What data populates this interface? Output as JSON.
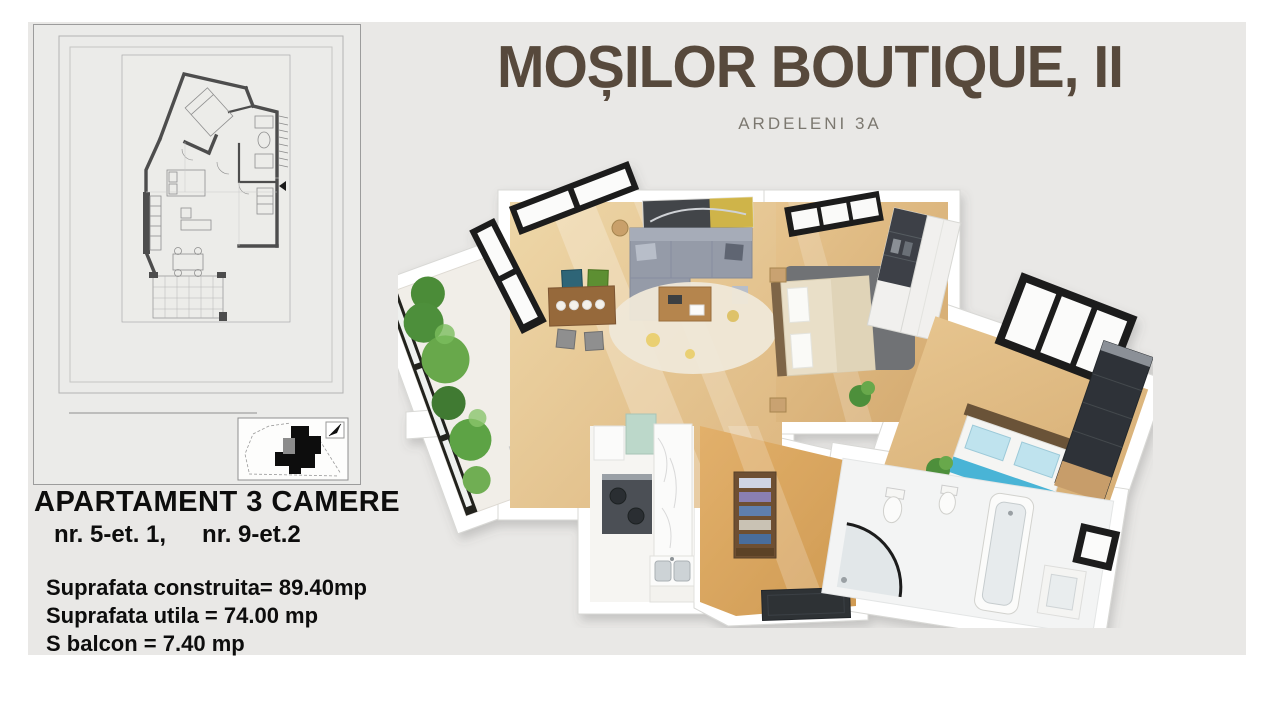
{
  "header": {
    "title": "MOȘILOR BOUTIQUE, II",
    "subtitle": "ARDELENI 3A"
  },
  "info": {
    "heading": "APARTAMENT 3 CAMERE",
    "unit_left": "nr. 5-et. 1,",
    "unit_right": "nr. 9-et.2",
    "areas": [
      "Suprafata construita= 89.40mp",
      "Suprafata utila = 74.00 mp",
      "S balcon = 7.40 mp"
    ]
  },
  "colors": {
    "page_bg": "#ffffff",
    "canvas_bg": "#e9e8e6",
    "title": "#57493c",
    "subtitle": "#7c7870",
    "text": "#0d0d0d",
    "plan_walls": "#4d4d4d",
    "wood_floor": "#ddb67f",
    "accent_blue_bed": "#49b4d6",
    "sofa_gray": "#959ba8",
    "plant_green": "#4e8f3a"
  },
  "floorplan_panel": {
    "type": "technical-2d-plan",
    "inset": "site-plan-with-north-arrow"
  },
  "render_3d": {
    "type": "3d-floorplan-top-view",
    "rooms": [
      "balcon",
      "living",
      "dining",
      "dormitor-1",
      "dormitor-2",
      "bucatarie",
      "hol",
      "baie"
    ]
  }
}
